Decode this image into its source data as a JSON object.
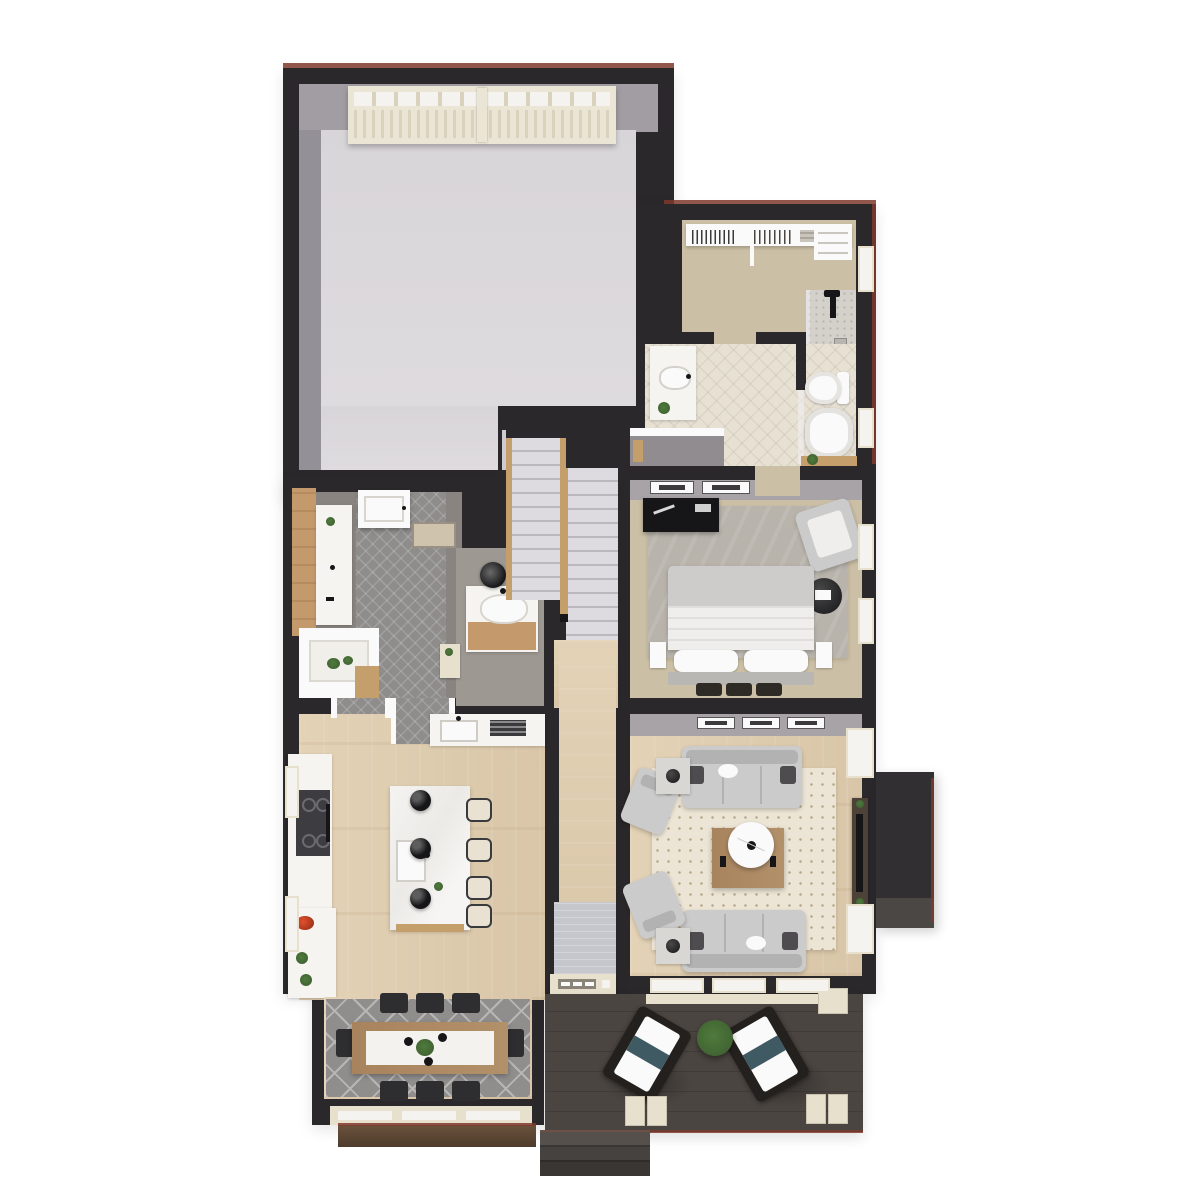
{
  "scene": {
    "type": "3d-rendered-floor-plan",
    "view": "top-down isometric dollhouse render, main level of a house",
    "background": "#ffffff",
    "visible_text": "none"
  },
  "palette": {
    "bg": "#ffffff",
    "wall": "#2b282b",
    "wallFace": "#a7a3a6",
    "roofline": "#7e3a2b",
    "garageFloor": "#d8d5d8",
    "garageFaceTop": "#a19da3",
    "garageFaceSide": "#949097",
    "garageDoor": "#eae5d4",
    "garageDoorSlat": "#d9d2bd",
    "windowWhite": "#f4f3f0",
    "white": "#fbfafa",
    "carpet": "#cbbfa5",
    "bathTile": "#e7e1d4",
    "showerTile": "#d4d1cb",
    "mudTile": "#8e8d8b",
    "mudBase": "#8a8480",
    "wood1": "#e3d2b6",
    "wood2": "#d9c6a8",
    "rugCream": "#ece5d5",
    "rugDot": "#b7a98b",
    "rugGray": "#b8b3ab",
    "rugDining": "#908e8d",
    "rugDiningLine": "#b9b7b5",
    "rugHall": "#c6c7cd",
    "deck": "#4b4541",
    "treadLight": "#dddbe0",
    "treadLine": "#bbb8c0",
    "stairWood": "#c49e6b",
    "island": "#eceae6",
    "sofa": "#cbcbcb",
    "sofaLine": "#b2b2b2",
    "pillowDark": "#4e4c4f",
    "black": "#161518",
    "counter": "#f5f4f1",
    "cooktop": "#3d3c40",
    "plant": "#4f7a3d",
    "plantDark": "#3c5c2e",
    "tableWood": "#a8845e",
    "stool": "#e9e2d2",
    "stoolDark": "#3a3a3c",
    "chairDark": "#2e2d2f",
    "porchTrim": "#e7e0cd",
    "bedGray": "#cdccca",
    "tvWood": "#4c4238",
    "fireplace": "#312f31",
    "fireplaceFace": "#4b4744",
    "benchTan": "#cfc3ad",
    "vanityWood": "#c49a6c",
    "planterWood": "#4e3b2c",
    "teal": "#3f5a63"
  },
  "rooms": [
    {
      "name": "garage",
      "features": [
        "garage-door-with-windows",
        "empty-concrete-floor"
      ]
    },
    {
      "name": "walk-in-closet",
      "features": [
        "hanging-rods",
        "shelving",
        "carpet"
      ]
    },
    {
      "name": "shower-room",
      "features": [
        "shower-fixture",
        "glass-panel",
        "tile-floor"
      ]
    },
    {
      "name": "bathroom",
      "features": [
        "double-vanity",
        "toilet",
        "freestanding-tub",
        "plant",
        "patterned-tile"
      ]
    },
    {
      "name": "bedroom",
      "features": [
        "bed",
        "dresser",
        "armchair",
        "round-side-table",
        "area-rug",
        "wall-art",
        "windows"
      ]
    },
    {
      "name": "living-room",
      "features": [
        "two-sofas",
        "two-armchairs",
        "coffee-table-with-round-tray",
        "side-tables-with-lamps",
        "tv-console",
        "fireplace",
        "dotted-rug",
        "wall-art"
      ]
    },
    {
      "name": "kitchen",
      "features": [
        "marble-island-with-sink",
        "four-bar-stools",
        "three-black-pendants",
        "range-counter",
        "sink-counter",
        "fruit-bowl",
        "plants"
      ]
    },
    {
      "name": "dining-room",
      "features": [
        "wood-table-with-runner",
        "eight-chairs",
        "chandelier-with-greenery",
        "geometric-rug",
        "bay-window",
        "planter-box"
      ]
    },
    {
      "name": "mudroom",
      "features": [
        "patterned-tile-runner",
        "bench",
        "laundry-counter",
        "wood-accent-wall",
        "garage-entry-door"
      ]
    },
    {
      "name": "pantry",
      "features": [
        "white-shelving",
        "plants"
      ]
    },
    {
      "name": "powder-room",
      "features": [
        "vanity",
        "round-black-mirror"
      ]
    },
    {
      "name": "stairs",
      "features": [
        "double-flight",
        "wood-railings",
        "light-treads"
      ]
    },
    {
      "name": "entry-hall",
      "features": [
        "front-door",
        "gray-rug",
        "wood-floor"
      ]
    },
    {
      "name": "porch",
      "features": [
        "two-lounge-chairs",
        "potted-plant",
        "column-bases",
        "steps",
        "dark-decking"
      ]
    }
  ]
}
